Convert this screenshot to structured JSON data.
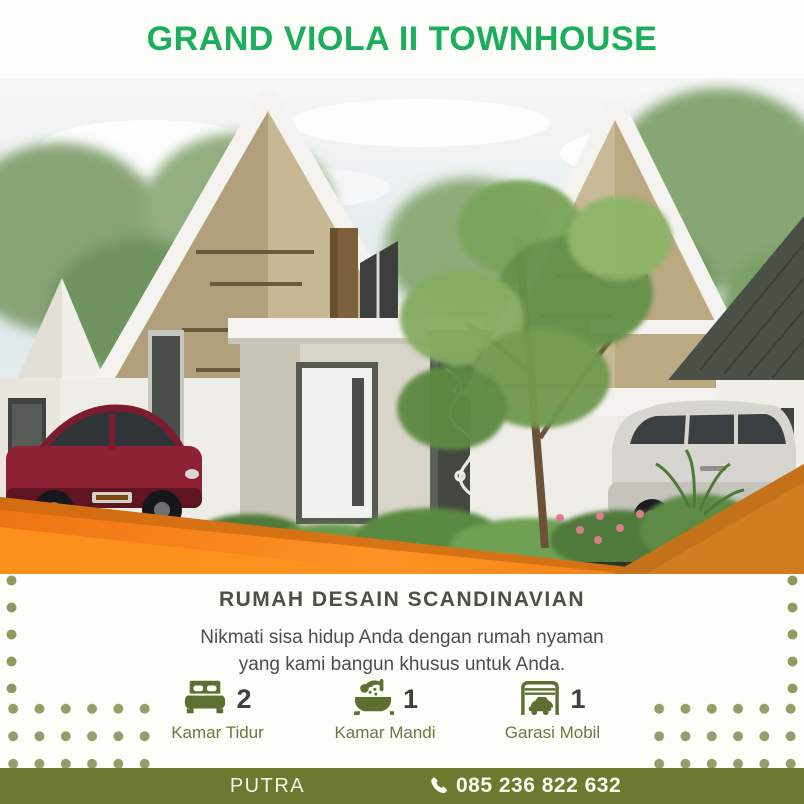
{
  "header": {
    "title": "GRAND VIOLA II TOWNHOUSE"
  },
  "hero": {
    "subject": "scandinavian-townhouse-render"
  },
  "content": {
    "heading": "RUMAH DESAIN SCANDINAVIAN",
    "body_line1": "Nikmati sisa hidup Anda dengan rumah nyaman",
    "body_line2": "yang kami bangun khusus untuk Anda.",
    "features": [
      {
        "icon": "bed-icon",
        "count": "2",
        "label": "Kamar Tidur"
      },
      {
        "icon": "bath-icon",
        "count": "1",
        "label": "Kamar Mandi"
      },
      {
        "icon": "garage-icon",
        "count": "1",
        "label": "Garasi Mobil"
      }
    ]
  },
  "footer": {
    "brand": "PUTRA",
    "phone_icon": "phone-icon",
    "phone": "085 236 822 632"
  },
  "colors": {
    "title_green": "#1cae5b",
    "footer_olive": "#6b7a2f",
    "icon_olive": "#5d7030",
    "label_olive": "#6e7742",
    "text_dark": "#49504a",
    "dot_olive": "#8c9258",
    "orange_bright": "#f8891c",
    "orange_dark": "#cf7d1f"
  }
}
